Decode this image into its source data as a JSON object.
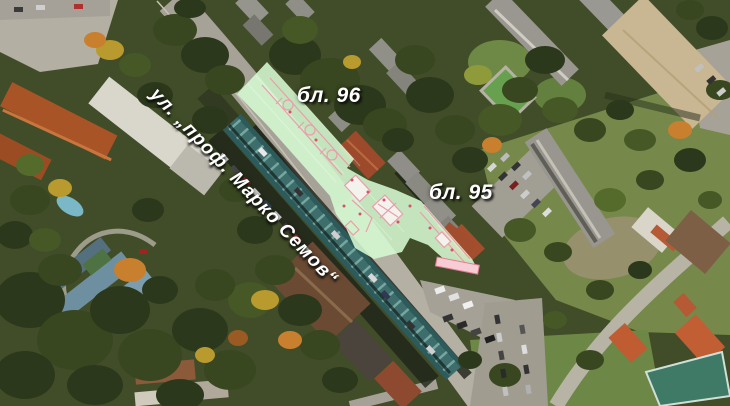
{
  "map": {
    "kind": "aerial-photo-with-site-plan-overlay",
    "labels": {
      "block_96": "бл. 96",
      "block_95": "бл. 95",
      "street": "ул. „проф. Марко Семов“"
    },
    "overlay": {
      "fill_color": "#d5f9d2",
      "plan_line_color": "#ee9aab",
      "tip_bar_color": "#f8ccd4"
    },
    "label_style": {
      "text_color": "#ffffff",
      "shadow_color": "#141414"
    }
  }
}
